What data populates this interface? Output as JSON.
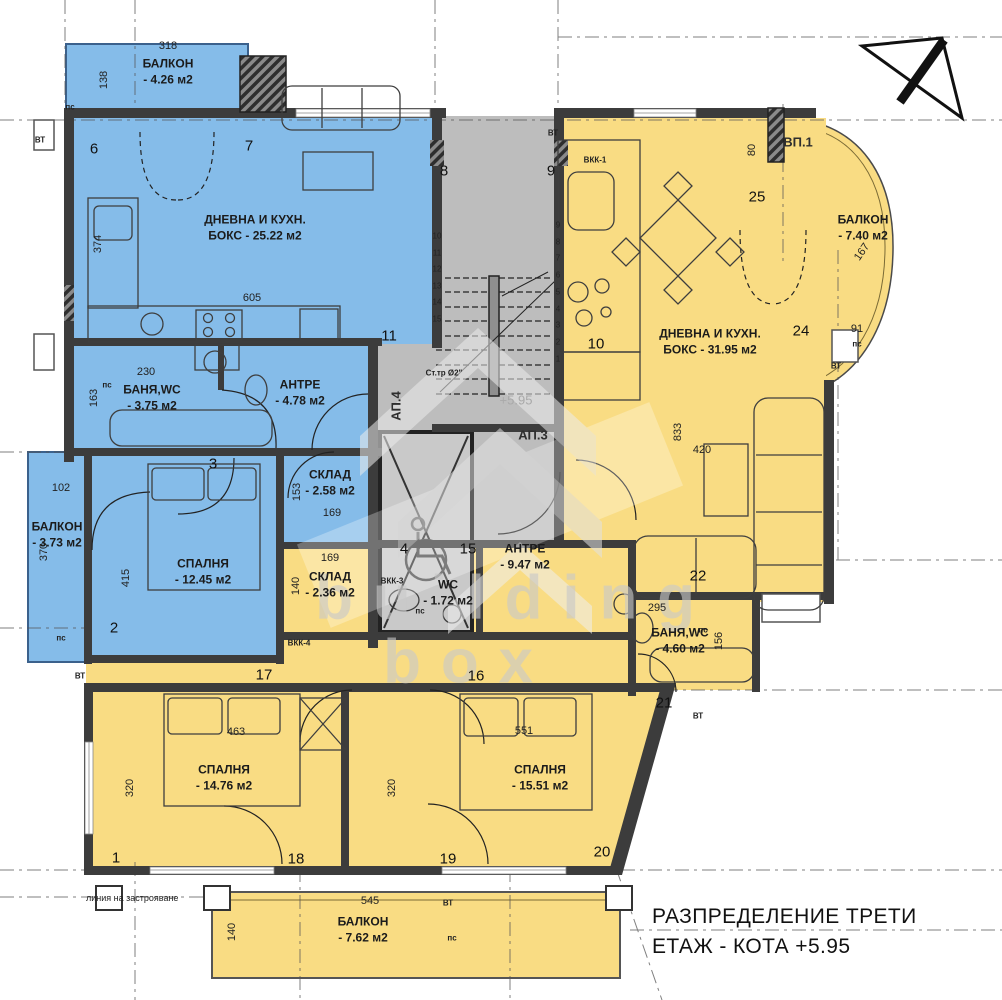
{
  "title": {
    "line1": "РАЗПРЕДЕЛЕНИЕ ТРЕТИ",
    "line2": "ЕТАЖ - КОТА +5.95"
  },
  "watermark": {
    "line1": "building",
    "line2": "box",
    "level": "+5.95"
  },
  "site": {
    "building_line_label": "линия на застрояване"
  },
  "colors": {
    "blue": "#85bce9",
    "yellow": "#f9dc83",
    "stair": "#bdbdbd",
    "lift": "#c9c9c9",
    "wall": "#3c3c3c",
    "axis": "#555555"
  },
  "apartment_labels": [
    {
      "text": "АП.3",
      "x": 533,
      "y": 435,
      "vertical": false
    },
    {
      "text": "АП.4",
      "x": 396,
      "y": 406,
      "vertical": true
    },
    {
      "text": "ВП.1",
      "x": 798,
      "y": 142,
      "vertical": false
    }
  ],
  "rooms": [
    {
      "name": "БАЛКОН",
      "area": "- 4.26 м2",
      "x": 168,
      "y": 72
    },
    {
      "name": "ДНЕВНА И КУХН.",
      "area": "БОКС - 25.22 м2",
      "x": 255,
      "y": 228
    },
    {
      "name": "БАНЯ,WC",
      "area": "- 3.75 м2",
      "x": 152,
      "y": 398
    },
    {
      "name": "АНТРЕ",
      "area": "- 4.78 м2",
      "x": 300,
      "y": 393
    },
    {
      "name": "СКЛАД",
      "area": "- 2.58 м2",
      "x": 330,
      "y": 483
    },
    {
      "name": "СПАЛНЯ",
      "area": "- 12.45 м2",
      "x": 203,
      "y": 572
    },
    {
      "name": "БАЛКОН",
      "area": "- 3.73 м2",
      "x": 57,
      "y": 535
    },
    {
      "name": "ДНЕВНА И КУХН.",
      "area": "БОКС - 31.95 м2",
      "x": 710,
      "y": 342
    },
    {
      "name": "БАЛКОН",
      "area": "- 7.40 м2",
      "x": 863,
      "y": 228
    },
    {
      "name": "АНТРЕ",
      "area": "- 9.47 м2",
      "x": 525,
      "y": 557
    },
    {
      "name": "WC",
      "area": "- 1.72 м2",
      "x": 448,
      "y": 593
    },
    {
      "name": "СКЛАД",
      "area": "- 2.36 м2",
      "x": 330,
      "y": 585
    },
    {
      "name": "БАНЯ,WC",
      "area": "- 4.60 м2",
      "x": 680,
      "y": 641
    },
    {
      "name": "СПАЛНЯ",
      "area": "- 14.76 м2",
      "x": 224,
      "y": 778
    },
    {
      "name": "СПАЛНЯ",
      "area": "- 15.51 м2",
      "x": 540,
      "y": 778
    },
    {
      "name": "БАЛКОН",
      "area": "- 7.62 м2",
      "x": 363,
      "y": 930
    }
  ],
  "dimensions": [
    {
      "t": "318",
      "x": 168,
      "y": 46,
      "r": 0
    },
    {
      "t": "138",
      "x": 104,
      "y": 80,
      "r": 90
    },
    {
      "t": "374",
      "x": 98,
      "y": 244,
      "r": 90
    },
    {
      "t": "605",
      "x": 252,
      "y": 298,
      "r": 0
    },
    {
      "t": "230",
      "x": 146,
      "y": 372,
      "r": 0
    },
    {
      "t": "163",
      "x": 94,
      "y": 398,
      "r": 90
    },
    {
      "t": "102",
      "x": 61,
      "y": 488,
      "r": 0
    },
    {
      "t": "370",
      "x": 44,
      "y": 552,
      "r": 90
    },
    {
      "t": "415",
      "x": 126,
      "y": 578,
      "r": 90
    },
    {
      "t": "153",
      "x": 297,
      "y": 492,
      "r": 90
    },
    {
      "t": "169",
      "x": 332,
      "y": 513,
      "r": 0
    },
    {
      "t": "169",
      "x": 330,
      "y": 558,
      "r": 0
    },
    {
      "t": "140",
      "x": 296,
      "y": 586,
      "r": 90
    },
    {
      "t": "463",
      "x": 236,
      "y": 732,
      "r": 0
    },
    {
      "t": "320",
      "x": 130,
      "y": 788,
      "r": 90
    },
    {
      "t": "320",
      "x": 392,
      "y": 788,
      "r": 90
    },
    {
      "t": "551",
      "x": 524,
      "y": 731,
      "r": 0
    },
    {
      "t": "545",
      "x": 370,
      "y": 901,
      "r": 0
    },
    {
      "t": "140",
      "x": 232,
      "y": 932,
      "r": 90
    },
    {
      "t": "833",
      "x": 678,
      "y": 432,
      "r": 90
    },
    {
      "t": "420",
      "x": 702,
      "y": 450,
      "r": 0
    },
    {
      "t": "295",
      "x": 657,
      "y": 608,
      "r": 0
    },
    {
      "t": "156",
      "x": 719,
      "y": 641,
      "r": 90
    },
    {
      "t": "80",
      "x": 752,
      "y": 150,
      "r": 90
    },
    {
      "t": "167",
      "x": 862,
      "y": 252,
      "r": 55
    },
    {
      "t": "91",
      "x": 857,
      "y": 329,
      "r": 0
    }
  ],
  "grid_labels": [
    {
      "t": "1",
      "x": 116,
      "y": 858
    },
    {
      "t": "2",
      "x": 114,
      "y": 628
    },
    {
      "t": "3",
      "x": 213,
      "y": 464
    },
    {
      "t": "4",
      "x": 404,
      "y": 549
    },
    {
      "t": "6",
      "x": 94,
      "y": 149
    },
    {
      "t": "7",
      "x": 249,
      "y": 146
    },
    {
      "t": "8",
      "x": 444,
      "y": 171
    },
    {
      "t": "9",
      "x": 551,
      "y": 171
    },
    {
      "t": "10",
      "x": 596,
      "y": 344
    },
    {
      "t": "11",
      "x": 389,
      "y": 336
    },
    {
      "t": "15",
      "x": 468,
      "y": 549
    },
    {
      "t": "16",
      "x": 476,
      "y": 676
    },
    {
      "t": "17",
      "x": 264,
      "y": 675
    },
    {
      "t": "18",
      "x": 296,
      "y": 859
    },
    {
      "t": "19",
      "x": 448,
      "y": 859
    },
    {
      "t": "20",
      "x": 602,
      "y": 852
    },
    {
      "t": "21",
      "x": 664,
      "y": 703
    },
    {
      "t": "22",
      "x": 698,
      "y": 576
    },
    {
      "t": "24",
      "x": 801,
      "y": 331
    },
    {
      "t": "25",
      "x": 757,
      "y": 197
    }
  ],
  "stair_steps": [
    {
      "t": "1",
      "x": 558,
      "y": 359
    },
    {
      "t": "2",
      "x": 558,
      "y": 342
    },
    {
      "t": "3",
      "x": 558,
      "y": 325
    },
    {
      "t": "4",
      "x": 558,
      "y": 309
    },
    {
      "t": "5",
      "x": 558,
      "y": 292
    },
    {
      "t": "6",
      "x": 558,
      "y": 275
    },
    {
      "t": "7",
      "x": 558,
      "y": 258
    },
    {
      "t": "8",
      "x": 558,
      "y": 242
    },
    {
      "t": "9",
      "x": 558,
      "y": 225
    },
    {
      "t": "10",
      "x": 437,
      "y": 236
    },
    {
      "t": "11",
      "x": 437,
      "y": 253
    },
    {
      "t": "12",
      "x": 437,
      "y": 269
    },
    {
      "t": "13",
      "x": 437,
      "y": 286
    },
    {
      "t": "14",
      "x": 437,
      "y": 302
    },
    {
      "t": "15",
      "x": 437,
      "y": 319
    }
  ],
  "small_tags": [
    {
      "t": "пс",
      "x": 70,
      "y": 107
    },
    {
      "t": "пс",
      "x": 107,
      "y": 385
    },
    {
      "t": "пс",
      "x": 61,
      "y": 638
    },
    {
      "t": "пс",
      "x": 857,
      "y": 344
    },
    {
      "t": "пс",
      "x": 420,
      "y": 611
    },
    {
      "t": "пс",
      "x": 703,
      "y": 630
    },
    {
      "t": "пс",
      "x": 452,
      "y": 938
    },
    {
      "t": "ВТ",
      "x": 40,
      "y": 140
    },
    {
      "t": "ВТ",
      "x": 80,
      "y": 676
    },
    {
      "t": "ВТ",
      "x": 553,
      "y": 133
    },
    {
      "t": "ВТ",
      "x": 836,
      "y": 366
    },
    {
      "t": "ВТ",
      "x": 698,
      "y": 716
    },
    {
      "t": "ВТ",
      "x": 448,
      "y": 903
    },
    {
      "t": "ВКК-1",
      "x": 595,
      "y": 160
    },
    {
      "t": "ВКК-3",
      "x": 392,
      "y": 581
    },
    {
      "t": "ВКК-4",
      "x": 299,
      "y": 643
    },
    {
      "t": "Ст.тр Ø2\"",
      "x": 444,
      "y": 373
    }
  ]
}
